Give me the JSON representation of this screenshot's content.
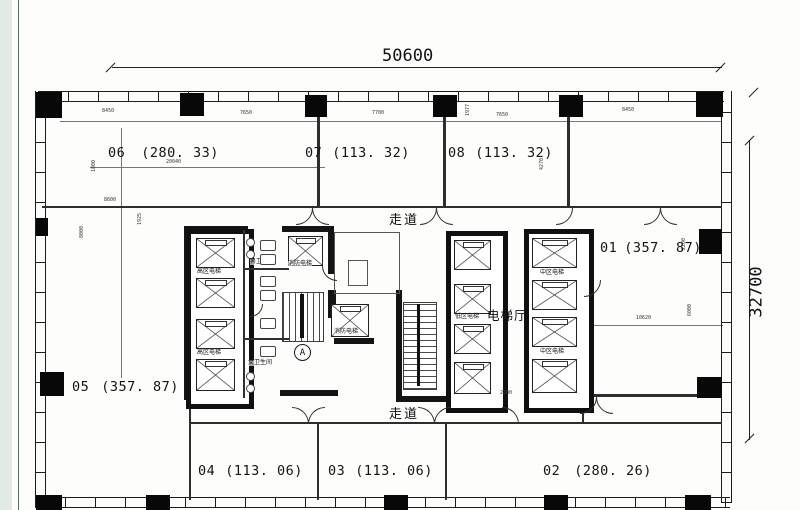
{
  "dimensions": {
    "overall_width": "50600",
    "overall_height": "32700",
    "top": [
      "8450",
      "7650",
      "7700",
      "1977",
      "7650",
      "8450"
    ],
    "left": [
      "1800",
      "8600",
      "8000",
      "1925"
    ],
    "room01": [
      "2200",
      "10620",
      "6000"
    ],
    "bottom": [
      "2300"
    ],
    "inner": [
      "20040",
      "4270"
    ]
  },
  "rooms": [
    {
      "id": "06",
      "area": "(280. 33)"
    },
    {
      "id": "07",
      "area": "(113. 32)"
    },
    {
      "id": "08",
      "area": "(113. 32)"
    },
    {
      "id": "01",
      "area": "(357. 87)"
    },
    {
      "id": "05",
      "area": "(357. 87)"
    },
    {
      "id": "04",
      "area": "(113. 06)"
    },
    {
      "id": "03",
      "area": "(113. 06)"
    },
    {
      "id": "02",
      "area": "(280. 26)"
    }
  ],
  "labels": {
    "corridor_top": "走道",
    "corridor_bottom": "走道",
    "elevator_hall": "电梯厅",
    "elevator_high": "高区电梯",
    "elevator_mid": "中区电梯",
    "elevator_low": "低区电梯",
    "elevator_fire": "消防电梯",
    "toilet_male": "男卫生间",
    "toilet_female": "女卫生间",
    "grid_marker": "A"
  }
}
